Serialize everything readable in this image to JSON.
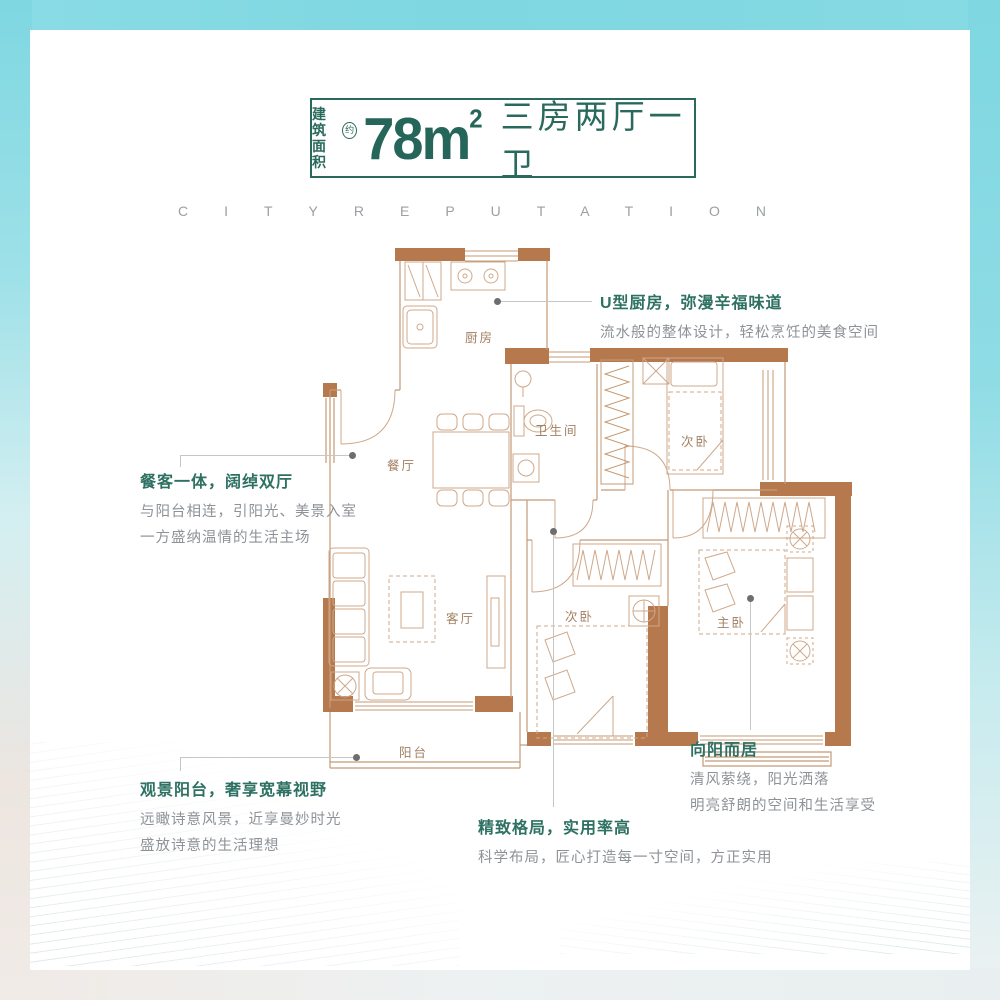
{
  "header": {
    "area_label_line1": "建筑",
    "area_label_line2": "面积",
    "approx_badge": "约",
    "area_value": "78m",
    "area_exponent": "2",
    "layout_text": "三房两厅一卫",
    "accent_color": "#2a6a5c"
  },
  "watermark": {
    "text": "CITYREPUTATION"
  },
  "floorplan": {
    "wall_color": "#b6794d",
    "line_color": "#c49a76",
    "furniture_color": "#cfa88a",
    "rooms": {
      "kitchen": "厨房",
      "dining": "餐厅",
      "bathroom": "卫生间",
      "bedroom_top": "次卧",
      "living": "客厅",
      "bedroom_mid": "次卧",
      "master": "主卧",
      "balcony": "阳台"
    }
  },
  "callouts": {
    "kitchen": {
      "title": "U型厨房，弥漫辛福味道",
      "desc": "流水般的整体设计，轻松烹饪的美食空间"
    },
    "dining": {
      "title": "餐客一体，阔绰双厅",
      "desc1": "与阳台相连，引阳光、美景入室",
      "desc2": "一方盛纳温情的生活主场"
    },
    "balcony": {
      "title": "观景阳台，奢享宽幕视野",
      "desc1": "远瞰诗意风景，近享曼妙时光",
      "desc2": "盛放诗意的生活理想"
    },
    "layout": {
      "title": "精致格局，实用率高",
      "desc": "科学布局，匠心打造每一寸空间，方正实用"
    },
    "master": {
      "title": "向阳而居",
      "desc1": "清风萦绕，阳光洒落",
      "desc2": "明亮舒朗的空间和生活享受"
    }
  }
}
